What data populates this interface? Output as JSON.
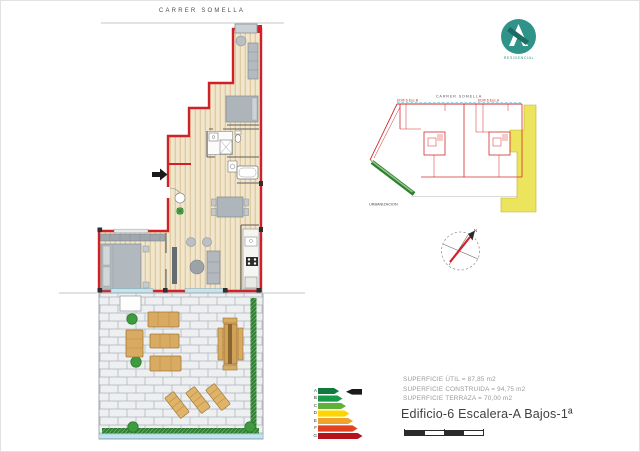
{
  "header": {
    "street_label": "CARRER SOMELLA"
  },
  "logo": {
    "brand_text": "RESIDENCIAL",
    "accent_color": "#2f9389"
  },
  "site_plan": {
    "street_label": "CARRER SOMELLA",
    "label_esc_b": "EDIF.6 Esc.B",
    "label_esc_a": "EDIF.6 Esc.A",
    "bottom_label": "URBANIZACION",
    "highlight_color": "#ece45c",
    "outline_color": "#d42b2b"
  },
  "compass": {
    "north_label": "N",
    "needle_color": "#cf2127"
  },
  "floor_plan": {
    "wall_color": "#cf2127",
    "wood_color": "#f1e6cb",
    "furniture_color": "#b2b8bd",
    "terrace_wood_color": "#d9ab62",
    "hedge_color": "#2e7d32",
    "glazing_color": "#c2e5f0"
  },
  "energy_label": {
    "grades": [
      {
        "letter": "A",
        "color": "#0e7a3c"
      },
      {
        "letter": "B",
        "color": "#169b47"
      },
      {
        "letter": "C",
        "color": "#5fb138"
      },
      {
        "letter": "D",
        "color": "#ffd500"
      },
      {
        "letter": "E",
        "color": "#efa32a"
      },
      {
        "letter": "F",
        "color": "#e2421f"
      },
      {
        "letter": "G",
        "color": "#b6121b"
      }
    ],
    "indicator_grade": "A"
  },
  "areas": {
    "util": "SUPERFICIE ÚTIL = 87,85 m2",
    "construida": "SUPERFICIE CONSTRUIDA = 94,75 m2",
    "terraza": "SUPERFICIE TERRAZA = 70,00 m2"
  },
  "title": {
    "text": "Edificio-6 Escalera-A Bajos-1ª"
  }
}
